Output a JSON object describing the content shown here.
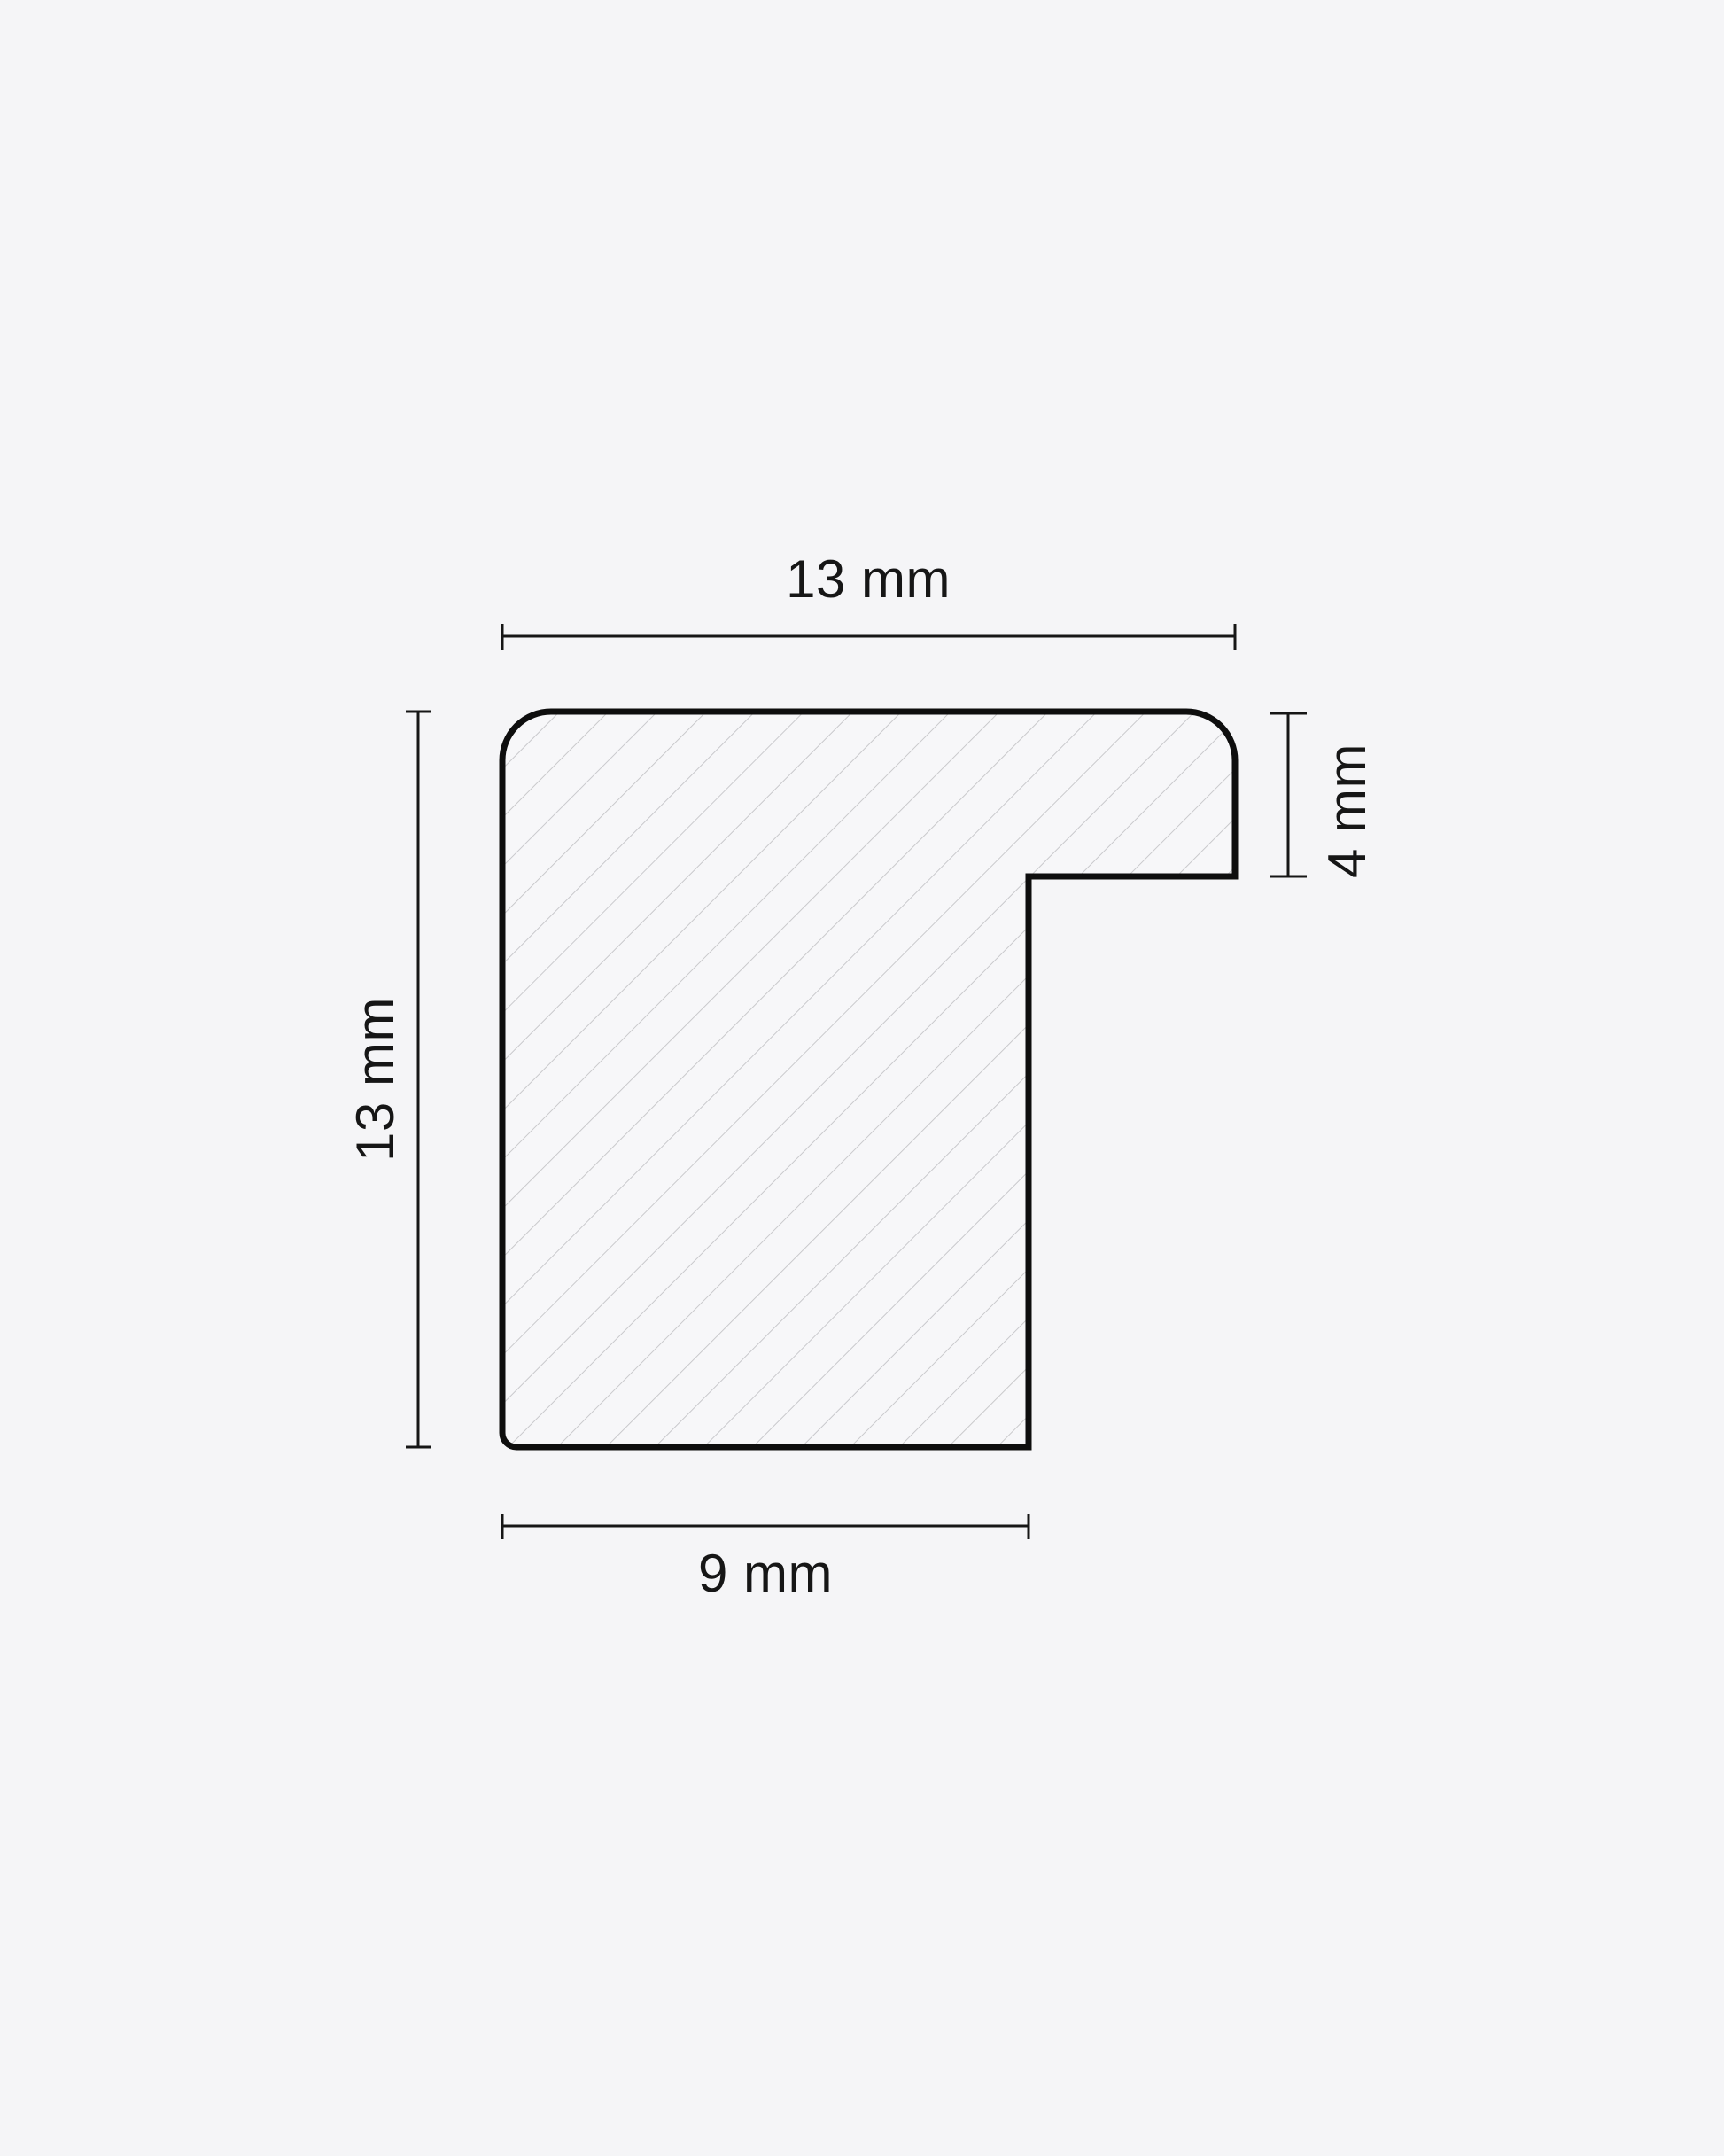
{
  "page": {
    "background": "#f5f5f7",
    "description": "Technical cross-section drawing of a frame moulding profile with hatching and dimension lines"
  },
  "colors": {
    "outline": "#0e0e0e",
    "dimension_line": "#161616",
    "text": "#161616",
    "hatch": "#c9c9cc",
    "shape_fill": "#f7f7f9"
  },
  "dimensions": {
    "top": {
      "label": "13 mm",
      "value": 13,
      "unit": "mm"
    },
    "left": {
      "label": "13 mm",
      "value": 13,
      "unit": "mm"
    },
    "right": {
      "label": "4 mm",
      "value": 4,
      "unit": "mm"
    },
    "bottom": {
      "label": "9 mm",
      "value": 9,
      "unit": "mm"
    }
  }
}
